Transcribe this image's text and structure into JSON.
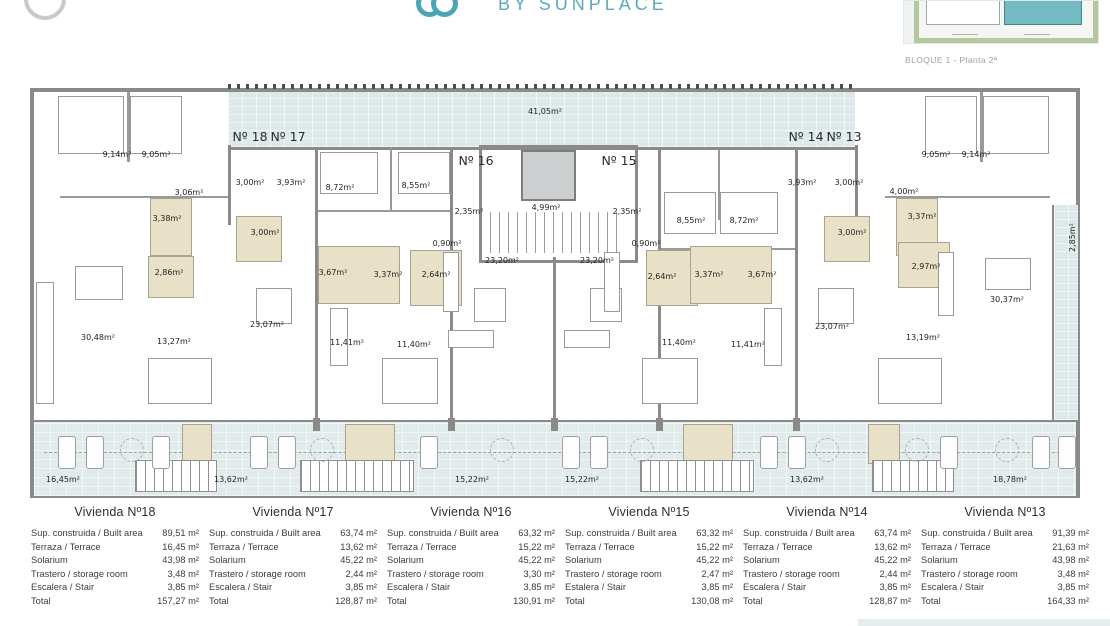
{
  "header": {
    "brand_text": "BY SUNPLACE",
    "thumbnail_caption": "BLOQUE 1 - Planta 2ª"
  },
  "colors": {
    "accent_teal": "#55abb8",
    "wall_gray": "#8a8a8a",
    "terrace_blue": "#dce8e9",
    "bath_beige": "#e9e0c8",
    "table_divider": "#b9d8db",
    "thumb_building_highlight": "#74bac3",
    "thumb_landscape_green": "#b5c79e"
  },
  "plan": {
    "unit_labels": [
      {
        "t": "Nº 18",
        "x": 250,
        "y": 129
      },
      {
        "t": "Nº 17",
        "x": 288,
        "y": 129
      },
      {
        "t": "Nº 16",
        "x": 476,
        "y": 153
      },
      {
        "t": "Nº 15",
        "x": 619,
        "y": 153
      },
      {
        "t": "Nº 14",
        "x": 806,
        "y": 129
      },
      {
        "t": "Nº 13",
        "x": 844,
        "y": 129
      }
    ],
    "room_labels": [
      {
        "t": "41,05m²",
        "x": 545,
        "y": 107
      },
      {
        "t": "9,14m²",
        "x": 117,
        "y": 150
      },
      {
        "t": "9,05m²",
        "x": 156,
        "y": 150
      },
      {
        "t": "3,06m²",
        "x": 189,
        "y": 188
      },
      {
        "t": "3,00m²",
        "x": 250,
        "y": 178
      },
      {
        "t": "3,93m²",
        "x": 291,
        "y": 178
      },
      {
        "t": "8,72m²",
        "x": 340,
        "y": 183
      },
      {
        "t": "8,55m²",
        "x": 416,
        "y": 181
      },
      {
        "t": "2,35m²",
        "x": 469,
        "y": 207
      },
      {
        "t": "4,99m²",
        "x": 546,
        "y": 203
      },
      {
        "t": "2,35m²",
        "x": 627,
        "y": 207
      },
      {
        "t": "0,90m²",
        "x": 447,
        "y": 239
      },
      {
        "t": "23,20m²",
        "x": 502,
        "y": 256
      },
      {
        "t": "23,20m²",
        "x": 597,
        "y": 256
      },
      {
        "t": "0,90m²",
        "x": 646,
        "y": 239
      },
      {
        "t": "8,55m²",
        "x": 691,
        "y": 216
      },
      {
        "t": "8,72m²",
        "x": 744,
        "y": 216
      },
      {
        "t": "3,93m²",
        "x": 802,
        "y": 178
      },
      {
        "t": "3,00m²",
        "x": 849,
        "y": 178
      },
      {
        "t": "4,00m²",
        "x": 904,
        "y": 187
      },
      {
        "t": "9,05m²",
        "x": 936,
        "y": 150
      },
      {
        "t": "9,14m²",
        "x": 976,
        "y": 150
      },
      {
        "t": "3,37m²",
        "x": 922,
        "y": 212
      },
      {
        "t": "3,38m²",
        "x": 167,
        "y": 214
      },
      {
        "t": "3,00m²",
        "x": 265,
        "y": 228
      },
      {
        "t": "3,00m²",
        "x": 852,
        "y": 228
      },
      {
        "t": "2,86m²",
        "x": 169,
        "y": 268
      },
      {
        "t": "3,67m²",
        "x": 333,
        "y": 268
      },
      {
        "t": "3,37m²",
        "x": 388,
        "y": 270
      },
      {
        "t": "2,64m²",
        "x": 436,
        "y": 270
      },
      {
        "t": "2,64m²",
        "x": 662,
        "y": 272
      },
      {
        "t": "3,37m²",
        "x": 709,
        "y": 270
      },
      {
        "t": "3,67m²",
        "x": 762,
        "y": 270
      },
      {
        "t": "2,97m²",
        "x": 926,
        "y": 262
      },
      {
        "t": "30,48m²",
        "x": 98,
        "y": 333
      },
      {
        "t": "13,27m²",
        "x": 174,
        "y": 337
      },
      {
        "t": "23,07m²",
        "x": 267,
        "y": 320
      },
      {
        "t": "11,41m²",
        "x": 347,
        "y": 338
      },
      {
        "t": "11,40m²",
        "x": 414,
        "y": 340
      },
      {
        "t": "11,40m²",
        "x": 679,
        "y": 338
      },
      {
        "t": "11,41m²",
        "x": 748,
        "y": 340
      },
      {
        "t": "23,07m²",
        "x": 832,
        "y": 322
      },
      {
        "t": "13,19m²",
        "x": 923,
        "y": 333
      },
      {
        "t": "30,37m²",
        "x": 1007,
        "y": 295
      },
      {
        "t": "16,45m²",
        "x": 63,
        "y": 475
      },
      {
        "t": "13,62m²",
        "x": 231,
        "y": 475
      },
      {
        "t": "15,22m²",
        "x": 472,
        "y": 475
      },
      {
        "t": "15,22m²",
        "x": 582,
        "y": 475
      },
      {
        "t": "13,62m²",
        "x": 807,
        "y": 475
      },
      {
        "t": "18,78m²",
        "x": 1010,
        "y": 475
      }
    ],
    "vertical_labels": [
      {
        "t": "2,85m²",
        "x": 1068,
        "y": 252
      }
    ]
  },
  "tables": [
    {
      "title": "Vivienda Nº18",
      "rows": [
        [
          "Sup. construida / Built area",
          "89,51 m²"
        ],
        [
          "Terraza / Terrace",
          "16,45 m²"
        ],
        [
          "Solarium",
          "43,98 m²"
        ],
        [
          "Trastero / storage room",
          "3,48 m²"
        ],
        [
          "Escalera / Stair",
          "3,85 m²"
        ],
        [
          "Total",
          "157,27 m²"
        ]
      ]
    },
    {
      "title": "Vivienda Nº17",
      "rows": [
        [
          "Sup. construida / Built area",
          "63,74 m²"
        ],
        [
          "Terraza / Terrace",
          "13,62 m²"
        ],
        [
          "Solarium",
          "45,22 m²"
        ],
        [
          "Trastero / storage room",
          "2,44 m²"
        ],
        [
          "Escalera / Stair",
          "3,85 m²"
        ],
        [
          "Total",
          "128,87 m²"
        ]
      ]
    },
    {
      "title": "Vivienda Nº16",
      "rows": [
        [
          "Sup. construida / Built area",
          "63,32 m²"
        ],
        [
          "Terraza / Terrace",
          "15,22 m²"
        ],
        [
          "Solarium",
          "45,22 m²"
        ],
        [
          "Trastero / storage room",
          "3,30 m²"
        ],
        [
          "Escalera / Stair",
          "3,85 m²"
        ],
        [
          "Total",
          "130,91 m²"
        ]
      ]
    },
    {
      "title": "Vivienda Nº15",
      "rows": [
        [
          "Sup. construida / Built area",
          "63,32 m²"
        ],
        [
          "Terraza / Terrace",
          "15,22 m²"
        ],
        [
          "Solarium",
          "45,22 m²"
        ],
        [
          "Trastero / storage room",
          "2,47 m²"
        ],
        [
          "Estalera / Stair",
          "3,85 m²"
        ],
        [
          "Total",
          "130,08 m²"
        ]
      ]
    },
    {
      "title": "Vivienda Nº14",
      "rows": [
        [
          "Sup. construida / Built area",
          "63,74 m²"
        ],
        [
          "Terraza / Terrace",
          "13,62 m²"
        ],
        [
          "Solarium",
          "45,22 m²"
        ],
        [
          "Trastero / storage room",
          "2,44 m²"
        ],
        [
          "Escalera / Stair",
          "3,85 m²"
        ],
        [
          "Total",
          "128,87 m²"
        ]
      ]
    },
    {
      "title": "Vivienda Nº13",
      "rows": [
        [
          "Sup. construida / Built area",
          "91,39 m²"
        ],
        [
          "Terraza / Terrace",
          "21,63 m²"
        ],
        [
          "Solarium",
          "43,98 m²"
        ],
        [
          "Trastero / storage room",
          "3,48 m²"
        ],
        [
          "Escalera / Stair",
          "3,85 m²"
        ],
        [
          "Total",
          "164,33 m²"
        ]
      ]
    }
  ]
}
